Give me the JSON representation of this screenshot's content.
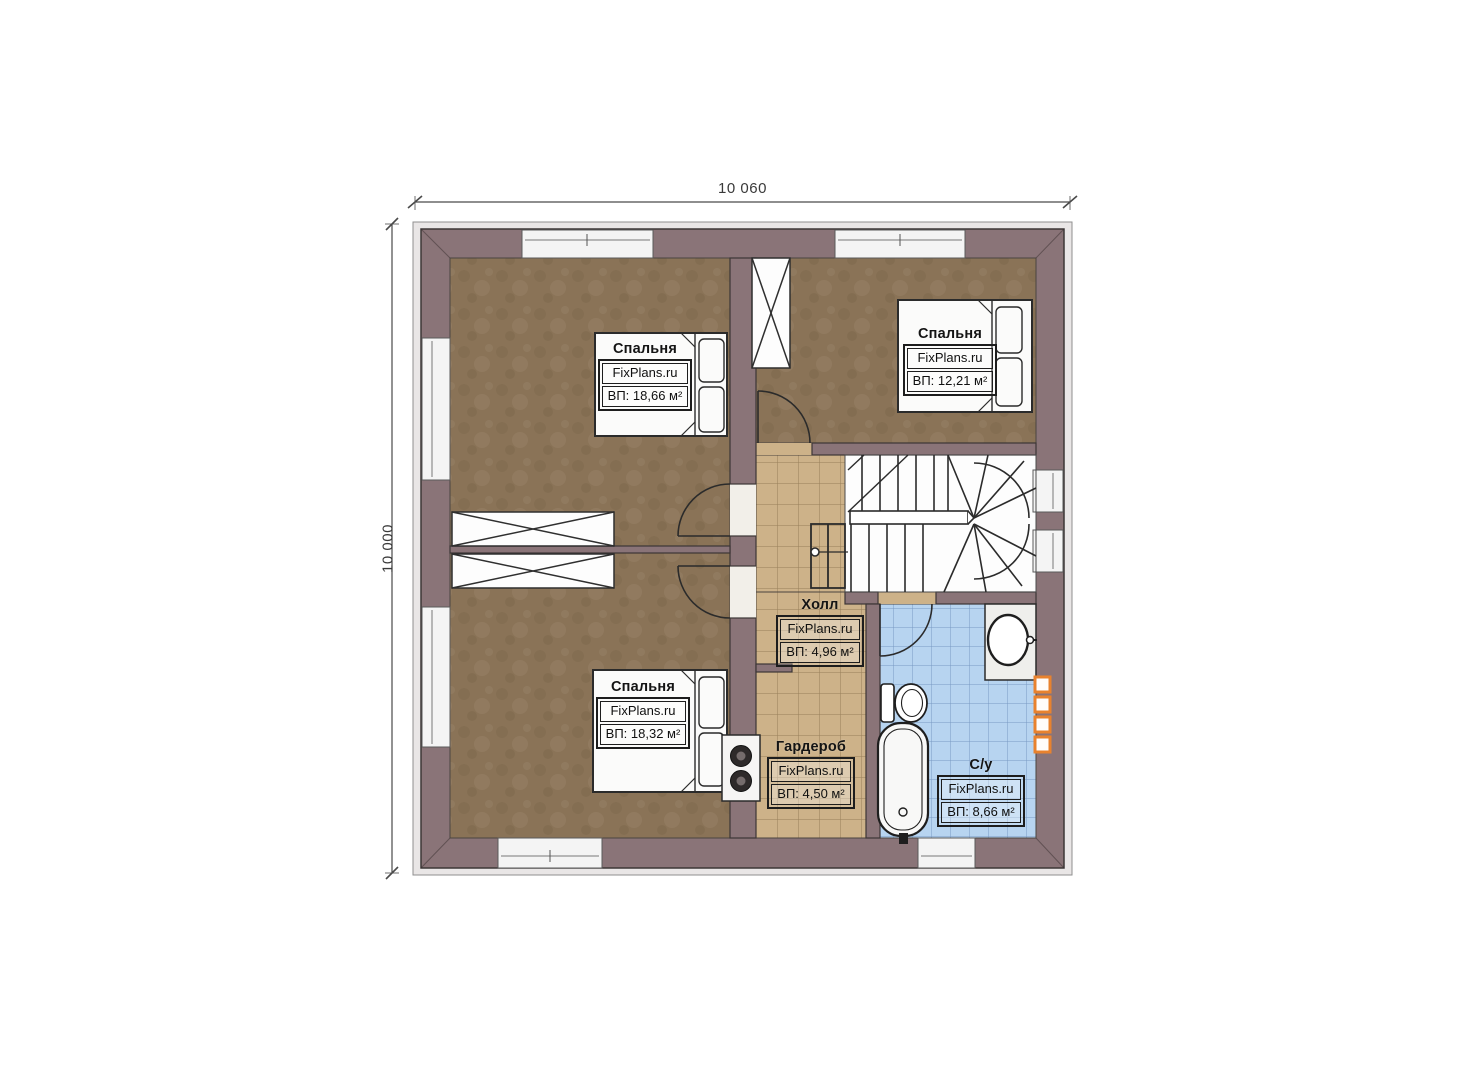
{
  "dimensions": {
    "top": "10 060",
    "left": "10 000"
  },
  "watermark": "FixPlans.ru",
  "rooms": {
    "bedroom_tl": {
      "name": "Спальня",
      "brand": "FixPlans.ru",
      "area": "ВП: 18,66 м²"
    },
    "bedroom_tr": {
      "name": "Спальня",
      "brand": "FixPlans.ru",
      "area": "ВП: 12,21 м²"
    },
    "bedroom_bl": {
      "name": "Спальня",
      "brand": "FixPlans.ru",
      "area": "ВП: 18,32 м²"
    },
    "hall": {
      "name": "Холл",
      "brand": "FixPlans.ru",
      "area": "ВП: 4,96 м²"
    },
    "wardrobe": {
      "name": "Гардероб",
      "brand": "FixPlans.ru",
      "area": "ВП: 4,50 м²"
    },
    "bathroom": {
      "name": "С/у",
      "brand": "FixPlans.ru",
      "area": "ВП: 8,66 м²"
    }
  },
  "colors": {
    "wall": "#8a7478",
    "bedroom_floor": "#8a7357",
    "tile_floor": "#cdb289",
    "bath_floor": "#b7d4f0",
    "towel_rail_accent": "#e8822e",
    "outline": "#2b2b2b"
  }
}
